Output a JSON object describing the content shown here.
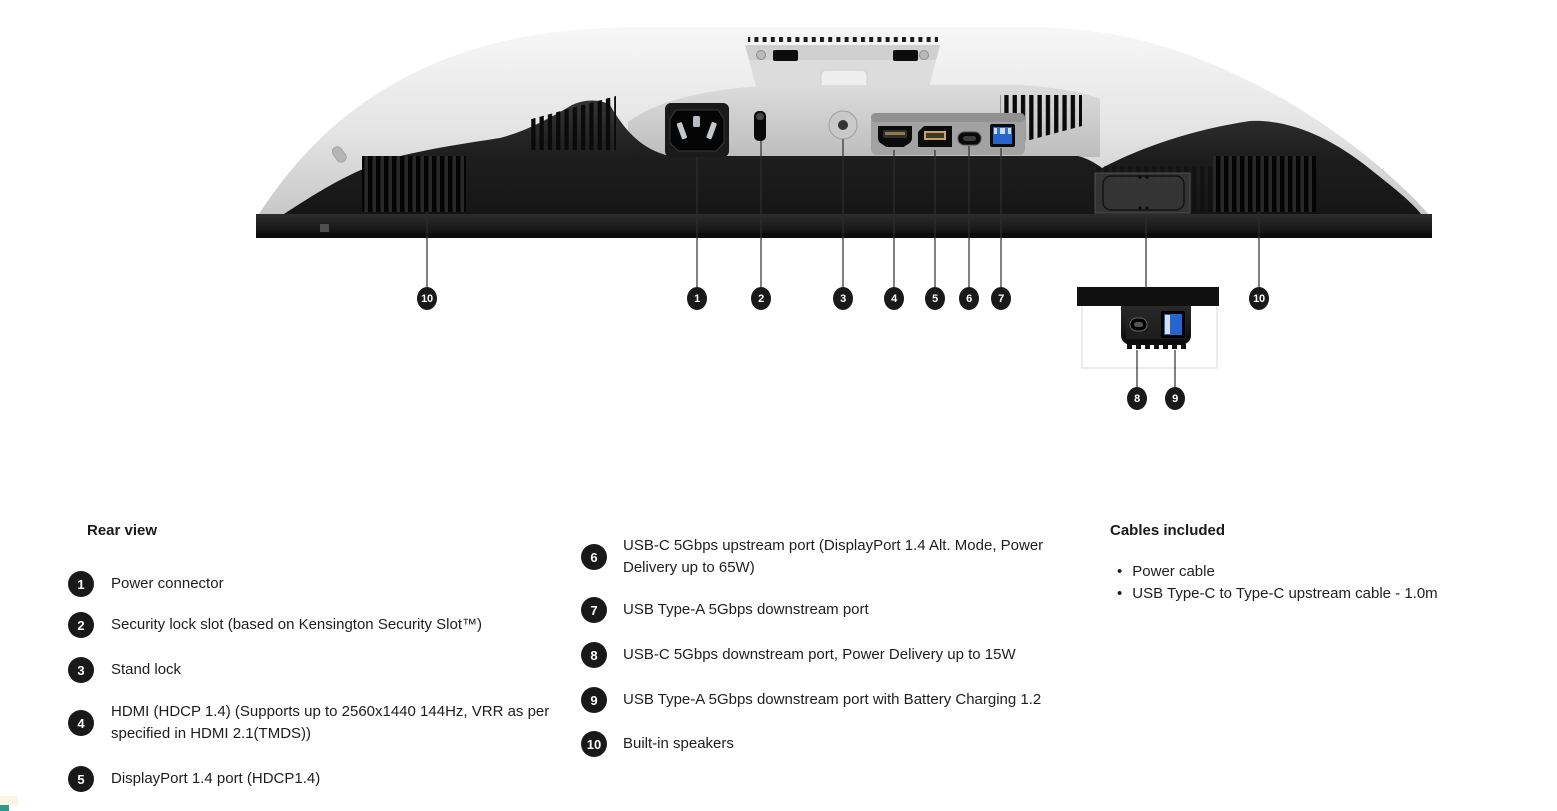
{
  "diagram": {
    "callout_numbers": [
      "1",
      "2",
      "3",
      "4",
      "5",
      "6",
      "7",
      "8",
      "9",
      "10"
    ]
  },
  "legend": {
    "rear_view": {
      "heading": "Rear view",
      "items": [
        {
          "number": "1",
          "label": "Power connector"
        },
        {
          "number": "2",
          "label": "Security lock slot (based on Kensington Security Slot™)"
        },
        {
          "number": "3",
          "label": "Stand lock"
        },
        {
          "number": "4",
          "label": "HDMI (HDCP 1.4) (Supports up to 2560x1440 144Hz, VRR as per specified in HDMI 2.1(TMDS))"
        },
        {
          "number": "5",
          "label": "DisplayPort 1.4 port (HDCP1.4)"
        }
      ]
    },
    "ports_continued": {
      "items": [
        {
          "number": "6",
          "label": "USB-C 5Gbps upstream port (DisplayPort 1.4 Alt. Mode, Power Delivery up to 65W)"
        },
        {
          "number": "7",
          "label": "USB Type-A 5Gbps downstream port"
        },
        {
          "number": "8",
          "label": "USB-C 5Gbps downstream port, Power Delivery up to 15W"
        },
        {
          "number": "9",
          "label": "USB Type-A 5Gbps downstream port with Battery Charging 1.2"
        },
        {
          "number": "10",
          "label": "Built-in speakers"
        }
      ]
    },
    "cables": {
      "heading": "Cables included",
      "items": [
        {
          "label": "Power cable"
        },
        {
          "label": "USB Type-C to Type-C upstream cable - 1.0m"
        }
      ]
    }
  },
  "colors": {
    "badge": "#191919",
    "usb_blue": "#2565cd",
    "body_silver": "#e4e4e4",
    "dark_panel": "#1d1d1d",
    "text": "#1e1e1e"
  }
}
